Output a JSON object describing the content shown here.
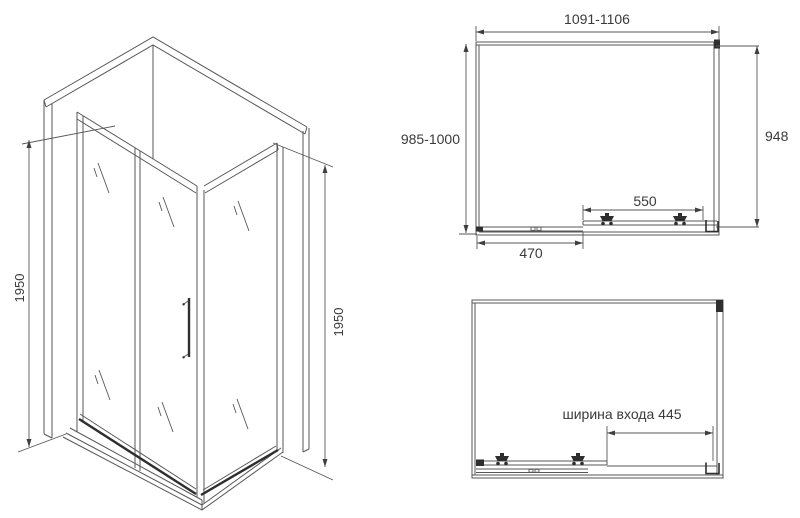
{
  "colors": {
    "background": "#ffffff",
    "line": "#575757",
    "dark": "#2e2e2e",
    "text": "#3a3a3a"
  },
  "isometric_view": {
    "height_left": "1950",
    "height_right": "1950"
  },
  "plan_view_top": {
    "width_range": "1091-1106",
    "depth_range": "985-1000",
    "side_width": "948",
    "door_width": "550",
    "fixed_panel_width": "470"
  },
  "plan_view_entrance": {
    "entrance_width": "ширина входа 445"
  }
}
